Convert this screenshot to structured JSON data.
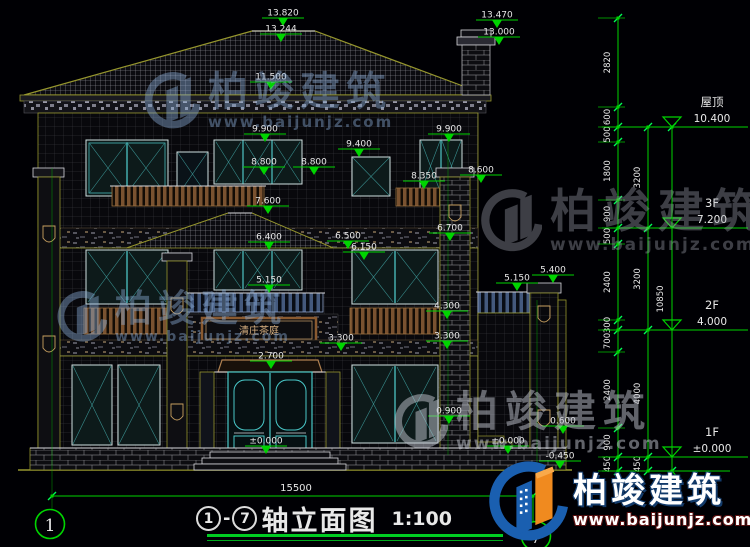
{
  "drawing": {
    "title": {
      "axis_start": "1",
      "axis_end": "7",
      "name": "轴立面图",
      "scale": "1:100"
    },
    "bottom_dim": "15500",
    "axis_bubbles": {
      "left": "1",
      "right": "7"
    },
    "sign_text": "清庄茶庭",
    "elevation_marks": [
      {
        "value": "13.820",
        "x": 283,
        "y": 8
      },
      {
        "value": "13.244",
        "x": 281,
        "y": 24
      },
      {
        "value": "13.470",
        "x": 497,
        "y": 10
      },
      {
        "value": "13.000",
        "x": 499,
        "y": 27
      },
      {
        "value": "11.500",
        "x": 271,
        "y": 72
      },
      {
        "value": "9.900",
        "x": 265,
        "y": 124
      },
      {
        "value": "9.900",
        "x": 449,
        "y": 124
      },
      {
        "value": "9.400",
        "x": 359,
        "y": 139
      },
      {
        "value": "8.800",
        "x": 264,
        "y": 157
      },
      {
        "value": "8.800",
        "x": 314,
        "y": 157
      },
      {
        "value": "8.350",
        "x": 424,
        "y": 171
      },
      {
        "value": "8.600",
        "x": 481,
        "y": 165
      },
      {
        "value": "7.600",
        "x": 268,
        "y": 196
      },
      {
        "value": "6.400",
        "x": 269,
        "y": 232
      },
      {
        "value": "6.500",
        "x": 348,
        "y": 231
      },
      {
        "value": "6.150",
        "x": 364,
        "y": 242
      },
      {
        "value": "6.700",
        "x": 450,
        "y": 223
      },
      {
        "value": "5.150",
        "x": 269,
        "y": 275
      },
      {
        "value": "5.150",
        "x": 517,
        "y": 273
      },
      {
        "value": "5.400",
        "x": 553,
        "y": 265
      },
      {
        "value": "4.300",
        "x": 447,
        "y": 301
      },
      {
        "value": "3.300",
        "x": 341,
        "y": 333
      },
      {
        "value": "3.300",
        "x": 447,
        "y": 331
      },
      {
        "value": "2.700",
        "x": 271,
        "y": 351
      },
      {
        "value": "0.900",
        "x": 449,
        "y": 406
      },
      {
        "value": "0.600",
        "x": 563,
        "y": 416
      },
      {
        "value": "±0.000",
        "x": 266,
        "y": 436
      },
      {
        "value": "±0.000",
        "x": 508,
        "y": 436
      },
      {
        "value": "-0.450",
        "x": 560,
        "y": 451
      }
    ],
    "dim_chains": [
      {
        "x": 618,
        "label_x": 610,
        "ticks": [
          18,
          107,
          127,
          142,
          200,
          228,
          244,
          320,
          330,
          352,
          428,
          457,
          471
        ],
        "labels": [
          "2820",
          "600",
          "500",
          "1800",
          "900",
          "500",
          "2400",
          "300",
          "700",
          "2400",
          "900",
          "450"
        ]
      },
      {
        "x": 648,
        "label_x": 640,
        "ticks": [
          127,
          228,
          330,
          457,
          471
        ],
        "labels": [
          "3200",
          "3200",
          "4000",
          "450"
        ]
      },
      {
        "x": 672,
        "label_x": 663,
        "ticks": [
          127,
          471
        ],
        "labels": [
          "10850"
        ]
      }
    ],
    "floor_levels": [
      {
        "label": "屋顶",
        "value": "10.400",
        "y": 127
      },
      {
        "label": "3F",
        "value": "7.200",
        "y": 228
      },
      {
        "label": "2F",
        "value": "4.000",
        "y": 330
      },
      {
        "label": "1F",
        "value": "±0.000",
        "y": 457
      }
    ]
  },
  "watermark": {
    "brand": "柏竣建筑",
    "url": "www.baijunjz.com"
  },
  "logo": {
    "brand": "柏竣建筑",
    "url": "www.baijunjz.com"
  }
}
